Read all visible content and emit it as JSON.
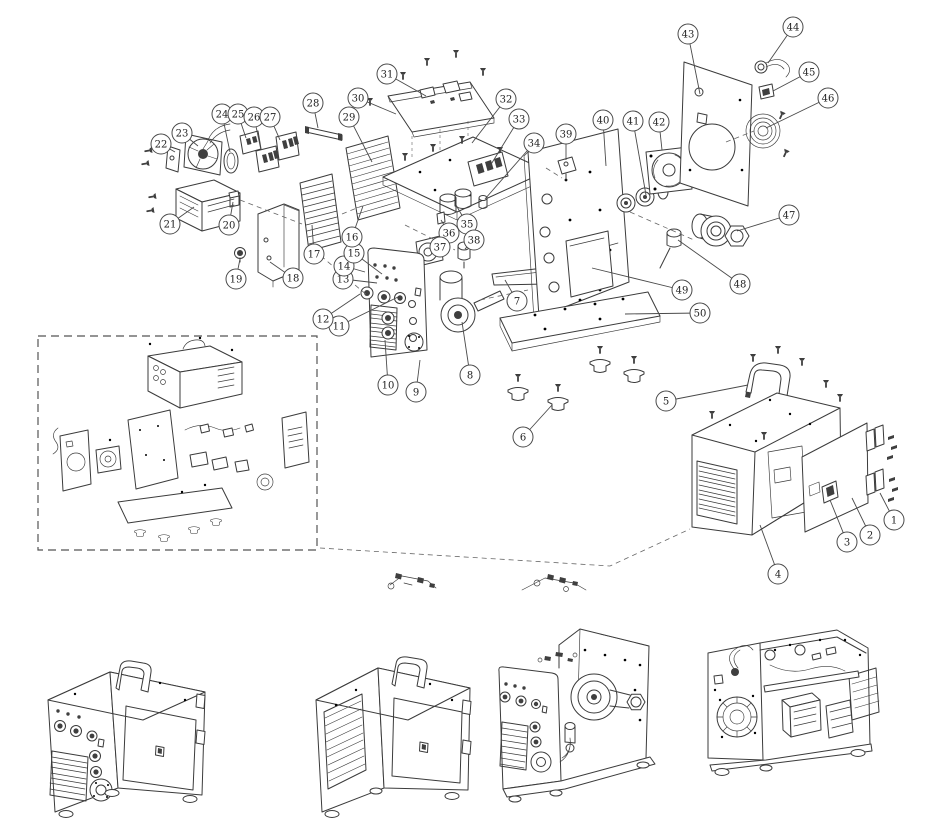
{
  "canvas": {
    "width": 945,
    "height": 839
  },
  "colors": {
    "background": "#ffffff",
    "line": "#3b3b3b",
    "callout_stroke": "#4a4a4a",
    "callout_fill": "#ffffff",
    "callout_text": "#222222"
  },
  "callout_style": {
    "radius": 10,
    "font_size": 10
  },
  "inset_box": {
    "x": 38,
    "y": 336,
    "width": 279,
    "height": 214
  },
  "callouts": [
    {
      "n": "1",
      "cx": 894,
      "cy": 520,
      "tx": 880,
      "ty": 493
    },
    {
      "n": "2",
      "cx": 870,
      "cy": 535,
      "tx": 852,
      "ty": 498
    },
    {
      "n": "3",
      "cx": 847,
      "cy": 542,
      "tx": 830,
      "ty": 500
    },
    {
      "n": "4",
      "cx": 778,
      "cy": 574,
      "tx": 760,
      "ty": 525
    },
    {
      "n": "5",
      "cx": 666,
      "cy": 401,
      "tx": 748,
      "ty": 385
    },
    {
      "n": "6",
      "cx": 523,
      "cy": 437,
      "tx": 552,
      "ty": 405
    },
    {
      "n": "7",
      "cx": 517,
      "cy": 301,
      "tx": 505,
      "ty": 280
    },
    {
      "n": "8",
      "cx": 470,
      "cy": 375,
      "tx": 462,
      "ty": 322
    },
    {
      "n": "9",
      "cx": 416,
      "cy": 392,
      "tx": 420,
      "ty": 360
    },
    {
      "n": "10",
      "cx": 388,
      "cy": 385,
      "tx": 385,
      "ty": 340
    },
    {
      "n": "11",
      "cx": 339,
      "cy": 326,
      "tx": 398,
      "ty": 297
    },
    {
      "n": "12",
      "cx": 323,
      "cy": 319,
      "tx": 360,
      "ty": 294
    },
    {
      "n": "13",
      "cx": 343,
      "cy": 279,
      "tx": 377,
      "ty": 283
    },
    {
      "n": "14",
      "cx": 344,
      "cy": 266,
      "tx": 365,
      "ty": 272
    },
    {
      "n": "15",
      "cx": 354,
      "cy": 253,
      "tx": 382,
      "ty": 274
    },
    {
      "n": "16",
      "cx": 352,
      "cy": 237,
      "tx": 363,
      "ty": 206
    },
    {
      "n": "17",
      "cx": 314,
      "cy": 254,
      "tx": 312,
      "ty": 225
    },
    {
      "n": "18",
      "cx": 293,
      "cy": 278,
      "tx": 270,
      "ty": 262
    },
    {
      "n": "19",
      "cx": 236,
      "cy": 279,
      "tx": 240,
      "ty": 259
    },
    {
      "n": "20",
      "cx": 229,
      "cy": 225,
      "tx": 233,
      "ty": 202
    },
    {
      "n": "21",
      "cx": 170,
      "cy": 224,
      "tx": 194,
      "ty": 207
    },
    {
      "n": "22",
      "cx": 161,
      "cy": 144,
      "tx": 175,
      "ty": 152
    },
    {
      "n": "23",
      "cx": 182,
      "cy": 133,
      "tx": 198,
      "ty": 146
    },
    {
      "n": "24",
      "cx": 222,
      "cy": 114,
      "tx": 230,
      "ty": 152
    },
    {
      "n": "25",
      "cx": 238,
      "cy": 114,
      "tx": 246,
      "ty": 138
    },
    {
      "n": "26",
      "cx": 254,
      "cy": 117,
      "tx": 261,
      "ty": 150
    },
    {
      "n": "27",
      "cx": 270,
      "cy": 117,
      "tx": 280,
      "ty": 140
    },
    {
      "n": "28",
      "cx": 313,
      "cy": 103,
      "tx": 318,
      "ty": 128
    },
    {
      "n": "29",
      "cx": 349,
      "cy": 117,
      "tx": 372,
      "ty": 162
    },
    {
      "n": "30",
      "cx": 358,
      "cy": 98,
      "tx": 396,
      "ty": 114
    },
    {
      "n": "31",
      "cx": 387,
      "cy": 74,
      "tx": 426,
      "ty": 96
    },
    {
      "n": "32",
      "cx": 506,
      "cy": 99,
      "tx": 472,
      "ty": 143
    },
    {
      "n": "33",
      "cx": 519,
      "cy": 119,
      "tx": 490,
      "ty": 166
    },
    {
      "n": "34",
      "cx": 534,
      "cy": 143,
      "tx": 485,
      "ty": 199
    },
    {
      "n": "35",
      "cx": 467,
      "cy": 224,
      "tx": 456,
      "ty": 205
    },
    {
      "n": "36",
      "cx": 449,
      "cy": 233,
      "tx": 441,
      "ty": 220
    },
    {
      "n": "37",
      "cx": 440,
      "cy": 247,
      "tx": 430,
      "ty": 250
    },
    {
      "n": "38",
      "cx": 474,
      "cy": 240,
      "tx": 465,
      "ty": 249
    },
    {
      "n": "39",
      "cx": 566,
      "cy": 134,
      "tx": 566,
      "ty": 160
    },
    {
      "n": "40",
      "cx": 603,
      "cy": 120,
      "tx": 606,
      "ty": 166
    },
    {
      "n": "41",
      "cx": 633,
      "cy": 121,
      "tx": 646,
      "ty": 195
    },
    {
      "n": "42",
      "cx": 659,
      "cy": 122,
      "tx": 662,
      "ty": 150
    },
    {
      "n": "43",
      "cx": 688,
      "cy": 34,
      "tx": 700,
      "ty": 94
    },
    {
      "n": "44",
      "cx": 793,
      "cy": 27,
      "tx": 768,
      "ty": 63
    },
    {
      "n": "45",
      "cx": 809,
      "cy": 72,
      "tx": 773,
      "ty": 91
    },
    {
      "n": "46",
      "cx": 828,
      "cy": 98,
      "tx": 766,
      "ty": 128
    },
    {
      "n": "47",
      "cx": 789,
      "cy": 215,
      "tx": 737,
      "ty": 231
    },
    {
      "n": "48",
      "cx": 740,
      "cy": 284,
      "tx": 678,
      "ty": 240
    },
    {
      "n": "49",
      "cx": 682,
      "cy": 290,
      "tx": 592,
      "ty": 268
    },
    {
      "n": "50",
      "cx": 700,
      "cy": 313,
      "tx": 625,
      "ty": 314
    }
  ]
}
